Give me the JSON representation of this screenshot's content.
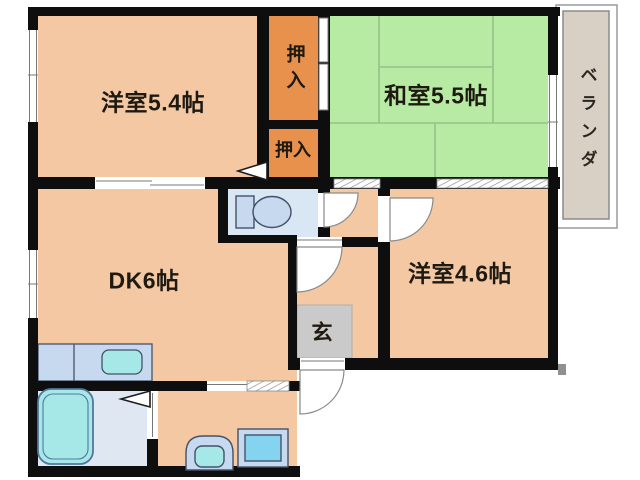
{
  "labels": {
    "western_room_1": "洋室5.4帖",
    "closet_upper": "押入",
    "closet_lower": "押入",
    "japanese_room": "和室5.5帖",
    "veranda": "ベランダ",
    "dining_kitchen": "DK6帖",
    "entrance": "玄",
    "western_room_2": "洋室4.6帖"
  },
  "colors": {
    "background": "#FFFFFF",
    "wall": "#0E0E0E",
    "room_floor": "#F3C8A3",
    "tatami": "#B7EBA3",
    "tatami_line": "#95C187",
    "closet": "#E8914C",
    "veranda": "#D8CFC5",
    "wet_floor": "#D9E7F4",
    "bath_floor": "#DEE7F2",
    "fixture_body": "#C6D9EE",
    "fixture_water": "#A6E8E8",
    "washer_inner": "#84D4F0",
    "entrance_floor": "#CACACA",
    "opening": "#FFFFFF",
    "text": "#1E1A12"
  }
}
